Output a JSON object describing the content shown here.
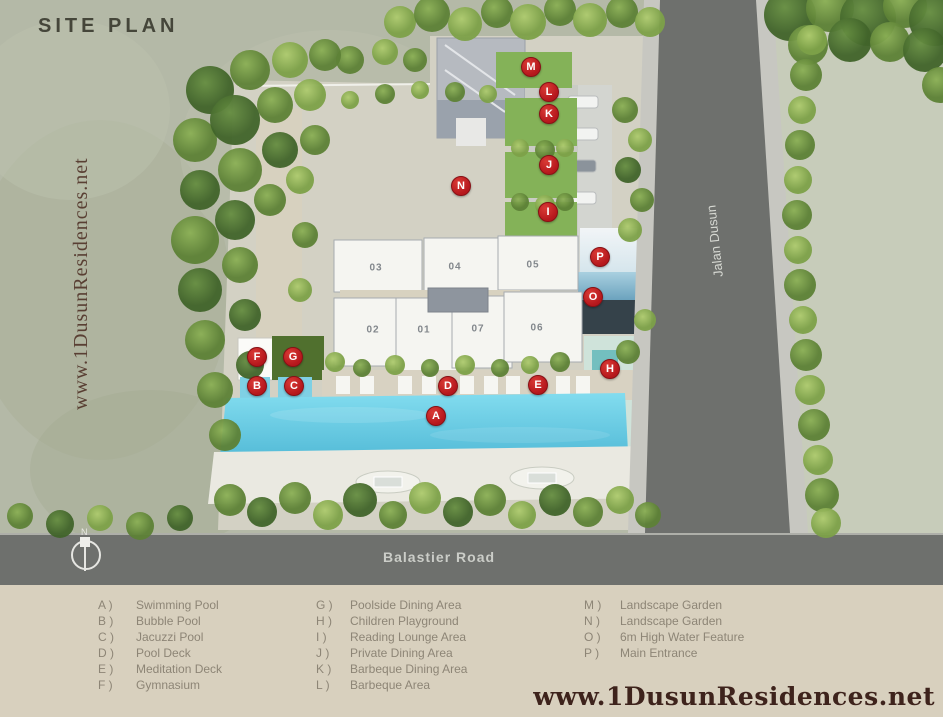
{
  "map": {
    "title": "SITE PLAN",
    "watermark_vertical": "www.1DusunResidences.net",
    "road_bottom_label": "Balastier Road",
    "road_right_label": "Jalan Dusun",
    "compass_label": "N",
    "buildings": [
      {
        "number": "01",
        "x": 424,
        "y": 330
      },
      {
        "number": "02",
        "x": 373,
        "y": 330
      },
      {
        "number": "03",
        "x": 376,
        "y": 268
      },
      {
        "number": "04",
        "x": 455,
        "y": 267
      },
      {
        "number": "05",
        "x": 533,
        "y": 265
      },
      {
        "number": "06",
        "x": 537,
        "y": 328
      },
      {
        "number": "07",
        "x": 478,
        "y": 329
      }
    ],
    "markers": [
      {
        "letter": "A",
        "x": 436,
        "y": 416
      },
      {
        "letter": "B",
        "x": 257,
        "y": 386
      },
      {
        "letter": "C",
        "x": 294,
        "y": 386
      },
      {
        "letter": "D",
        "x": 448,
        "y": 386
      },
      {
        "letter": "E",
        "x": 538,
        "y": 385
      },
      {
        "letter": "F",
        "x": 257,
        "y": 357
      },
      {
        "letter": "G",
        "x": 293,
        "y": 357
      },
      {
        "letter": "H",
        "x": 610,
        "y": 369
      },
      {
        "letter": "I",
        "x": 548,
        "y": 212
      },
      {
        "letter": "J",
        "x": 549,
        "y": 165
      },
      {
        "letter": "K",
        "x": 549,
        "y": 114
      },
      {
        "letter": "L",
        "x": 549,
        "y": 92
      },
      {
        "letter": "M",
        "x": 531,
        "y": 67
      },
      {
        "letter": "N",
        "x": 461,
        "y": 186
      },
      {
        "letter": "O",
        "x": 593,
        "y": 297
      },
      {
        "letter": "P",
        "x": 600,
        "y": 257
      }
    ]
  },
  "legend": {
    "columns": [
      {
        "items": [
          {
            "key": "A )",
            "label": "Swimming Pool"
          },
          {
            "key": "B )",
            "label": "Bubble Pool"
          },
          {
            "key": "C )",
            "label": "Jacuzzi Pool"
          },
          {
            "key": "D )",
            "label": "Pool Deck"
          },
          {
            "key": "E )",
            "label": "Meditation Deck"
          },
          {
            "key": "F )",
            "label": "Gymnasium"
          }
        ]
      },
      {
        "items": [
          {
            "key": "G )",
            "label": "Poolside Dining Area"
          },
          {
            "key": "H )",
            "label": "Children Playground"
          },
          {
            "key": "I )",
            "label": "Reading Lounge Area"
          },
          {
            "key": "J )",
            "label": "Private  Dining Area"
          },
          {
            "key": "K )",
            "label": "Barbeque Dining Area"
          },
          {
            "key": "L )",
            "label": "Barbeque Area"
          }
        ]
      },
      {
        "items": [
          {
            "key": "M )",
            "label": "Landscape Garden"
          },
          {
            "key": "N )",
            "label": "Landscape Garden"
          },
          {
            "key": "O )",
            "label": "6m High Water Feature"
          },
          {
            "key": "P )",
            "label": "Main Entrance"
          }
        ]
      }
    ],
    "watermark": "www.1DusunResidences.net"
  },
  "colors": {
    "marker_red": "#b5171c",
    "pool_cyan": "#6fd2e8",
    "road_gray": "#6e706d",
    "legend_bg": "#d8d0be",
    "watermark_maroon": "#3e231c",
    "title_olive": "#45463a"
  }
}
